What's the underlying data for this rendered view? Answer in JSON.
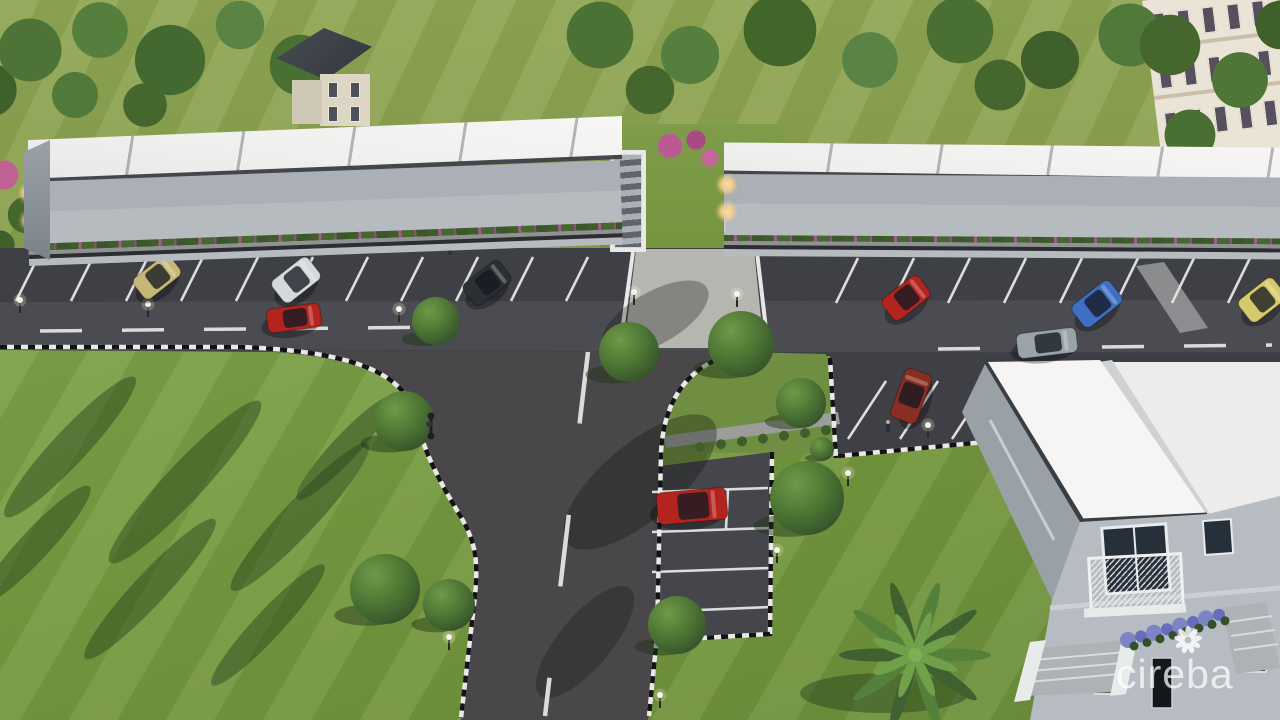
{
  "watermark": {
    "brand": "cireba",
    "logo": "cireba-flower-icon"
  },
  "scene": {
    "type": "architectural-rendering",
    "subject": "Aerial dusk view of a two-storey townhouse development with parking lots, entrance road and landscaping",
    "buildings": {
      "apartment_rows": 2,
      "units_per_row": 5,
      "stories": 2
    },
    "vehicles": [
      {
        "type": "sedan",
        "color_name": "tan",
        "state": "parked"
      },
      {
        "type": "van",
        "color_name": "white",
        "state": "parked"
      },
      {
        "type": "suv",
        "color_name": "black",
        "state": "parked"
      },
      {
        "type": "sedan",
        "color_name": "red",
        "state": "driving"
      },
      {
        "type": "sedan",
        "color_name": "red",
        "state": "parked"
      },
      {
        "type": "hatchback",
        "color_name": "blue",
        "state": "parked"
      },
      {
        "type": "hatchback",
        "color_name": "yellow",
        "state": "parked"
      },
      {
        "type": "sedan",
        "color_name": "silver",
        "state": "driving"
      },
      {
        "type": "suv",
        "color_name": "maroon",
        "state": "parked"
      },
      {
        "type": "sedan",
        "color_name": "red",
        "state": "parked-pad"
      }
    ],
    "palette": {
      "grass_field": "#8aa050",
      "grass_lawn": "#76993f",
      "grass_island": "#6f8e41",
      "tree": "#4e7634",
      "tree_dark": "#35542a",
      "tree_light": "#6f9a48",
      "asphalt": "#3f4045",
      "asphalt_road": "#4a474a",
      "asphalt_lane": "#6e7076",
      "roof_white": "#f4f3f0",
      "fascia": "#43474b",
      "wall_light": "#b6bbc0",
      "wall_dark": "#5a6167",
      "window": "#232830",
      "frame": "#dde0e2",
      "sidewalk": "#97999a",
      "concrete": "#b6b6b1",
      "curb_white": "#e9e9e7",
      "curb_black": "#131315",
      "paint_line": "#e4e5e4",
      "porch_light": "#ffd994",
      "hedge_pink": "#a85890",
      "shrub_purple": "#7d84c6",
      "palm": "#577e3a",
      "car_tan": "#c7b777",
      "car_white": "#d6d9dc",
      "car_black": "#2c2f33",
      "car_red": "#b3241e",
      "car_blue": "#3f6fc2",
      "car_yellow": "#d6c96a",
      "car_silver": "#9ba3aa",
      "car_maroon": "#8a2d22",
      "watermark_white": "#ffffff"
    }
  }
}
